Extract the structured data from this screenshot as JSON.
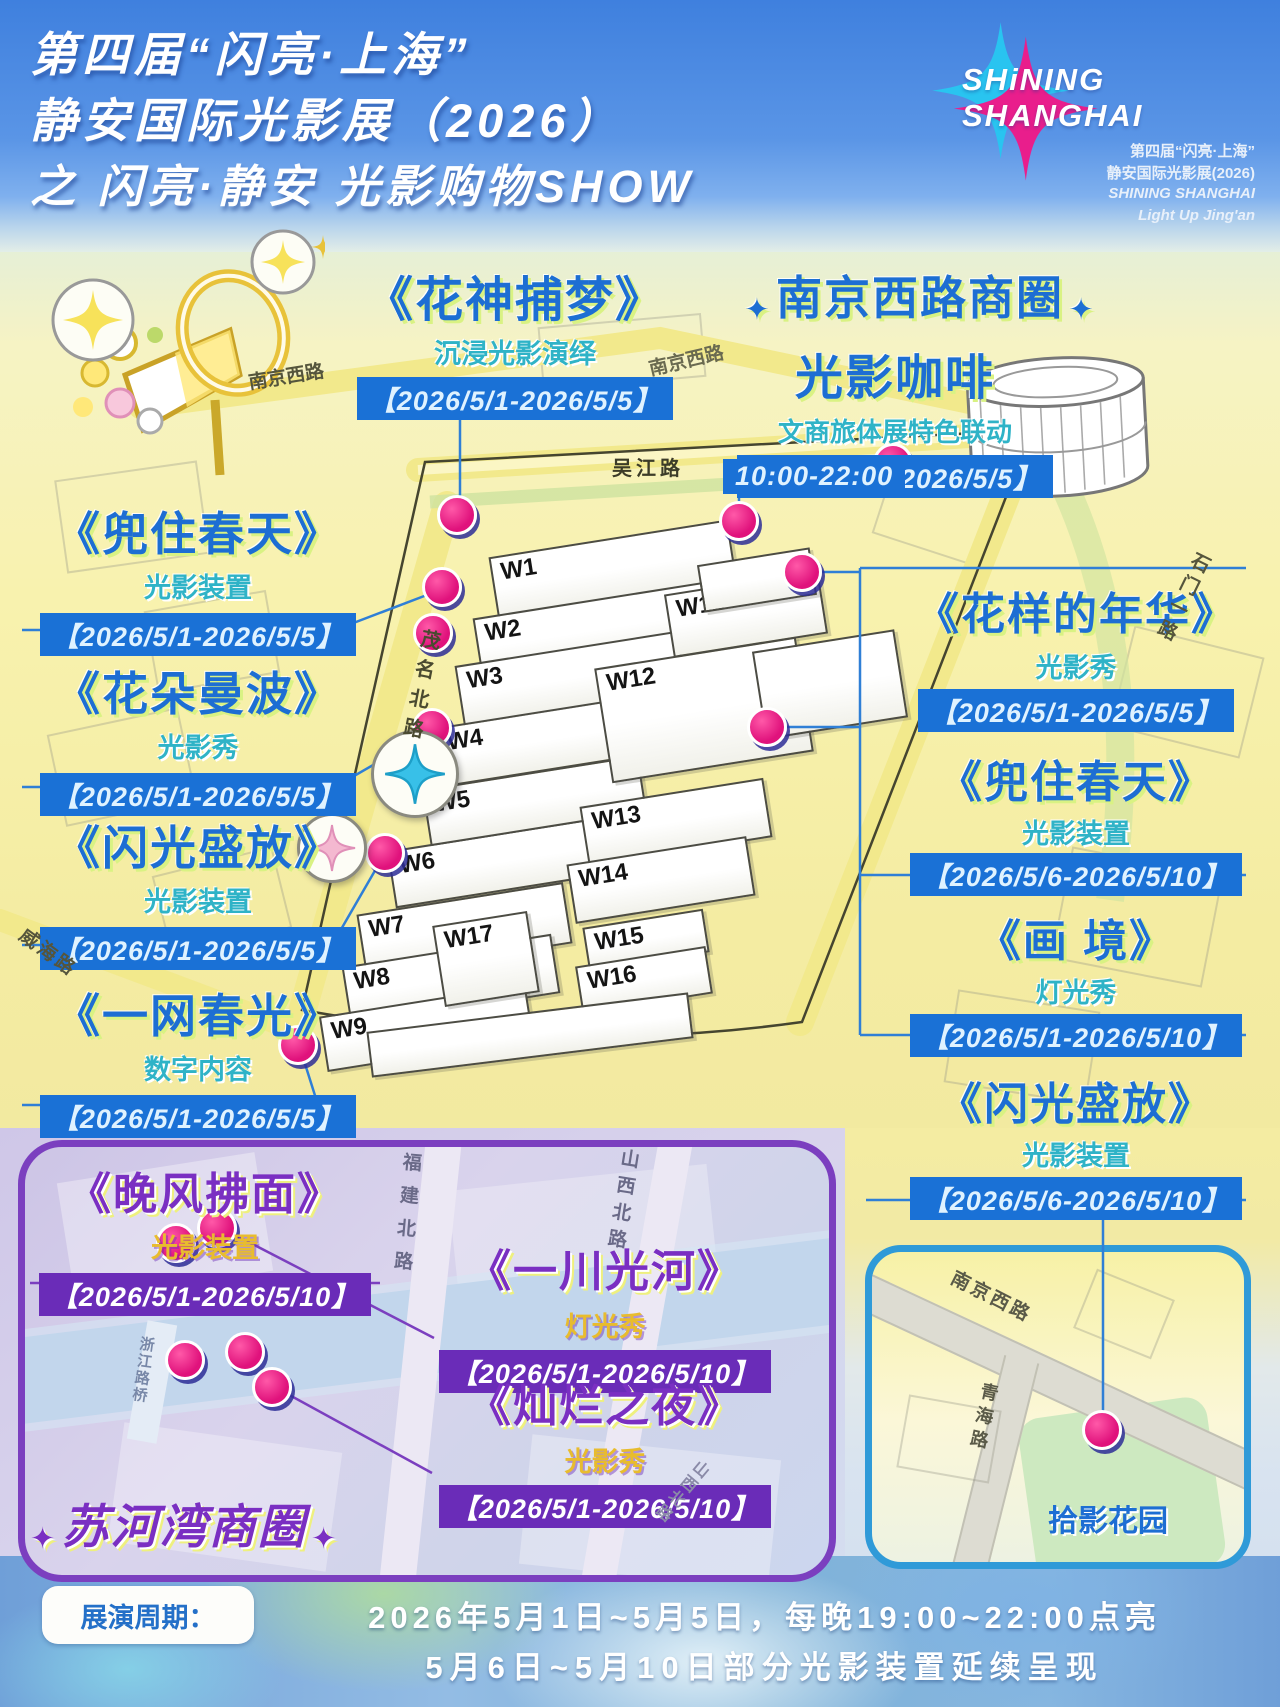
{
  "header": {
    "title_lines": [
      "第四届“闪亮·上海”",
      "静安国际光影展（2026）",
      "之 闪亮·静安 光影购物SHOW"
    ],
    "logo": {
      "name_line1": "SHiNING",
      "name_line2": "SHANGHAI",
      "sub_line1": "第四届“闪亮·上海”",
      "sub_line2": "静安国际光影展(2026)",
      "sub_line3": "SHINING SHANGHAI",
      "sub_line4": "Light Up Jing'an"
    }
  },
  "left_events": [
    {
      "title": "《花神捕梦》",
      "subtitle": "沉浸光影演绎",
      "dates": "【2026/5/1-2026/5/5】"
    },
    {
      "title": "《兜住春天》",
      "subtitle": "光影装置",
      "dates": "【2026/5/1-2026/5/5】"
    },
    {
      "title": "《花朵曼波》",
      "subtitle": "光影秀",
      "dates": "【2026/5/1-2026/5/5】"
    },
    {
      "title": "《闪光盛放》",
      "subtitle": "光影装置",
      "dates": "【2026/5/1-2026/5/5】"
    },
    {
      "title": "《一网春光》",
      "subtitle": "数字内容",
      "dates": "【2026/5/1-2026/5/5】"
    }
  ],
  "nanjing_west": {
    "sparkle": "✦",
    "district_title": "南京西路商圈",
    "coffee": {
      "title": "光影咖啡",
      "subtitle": "文商旅体展特色联动",
      "dates": "【2026/5/1-2026/5/5】",
      "time": "10:00-22:00"
    },
    "events": [
      {
        "title": "《花样的年华》",
        "subtitle": "光影秀",
        "dates": "【2026/5/1-2026/5/5】"
      },
      {
        "title": "《兜住春天》",
        "subtitle": "光影装置",
        "dates": "【2026/5/6-2026/5/10】"
      },
      {
        "title": "《画 境》",
        "subtitle": "灯光秀",
        "dates": "【2026/5/1-2026/5/10】"
      },
      {
        "title": "《闪光盛放》",
        "subtitle": "光影装置",
        "dates": "【2026/5/6-2026/5/10】"
      }
    ]
  },
  "suhewan": {
    "sparkle": "✦",
    "district_title": "苏河湾商圈",
    "events": [
      {
        "title": "《晚风拂面》",
        "subtitle": "光影装置",
        "dates": "【2026/5/1-2026/5/10】"
      },
      {
        "title": "《一川光河》",
        "subtitle": "灯光秀",
        "dates": "【2026/5/1-2026/5/10】"
      },
      {
        "title": "《灿烂之夜》",
        "subtitle": "光影秀",
        "dates": "【2026/5/1-2026/5/10】"
      }
    ],
    "roads": {
      "fujian": "福建北路",
      "shanxi": "山西北路",
      "bridge": "浙江路桥"
    }
  },
  "garden": {
    "label": "拾影花园",
    "roads": {
      "nanjing": "南京西路",
      "qinghai": "青海路"
    }
  },
  "map": {
    "roads": {
      "nanjing_tl": "南京西路",
      "nanjing_mid": "南京西路",
      "wujiang": "吴江路",
      "maoming": "茂名北路",
      "weihai": "威海路",
      "shimen": "石门一路"
    },
    "buildings": [
      "W1",
      "W2",
      "W3",
      "W4",
      "W5",
      "W6",
      "W7",
      "W8",
      "W9",
      "W11",
      "W12",
      "W13",
      "W14",
      "W15",
      "W16",
      "W17"
    ]
  },
  "footer": {
    "label": "展演周期：",
    "line1": "2026年5月1日~5月5日，每晚19:00~22:00点亮",
    "line2": "5月6日~5月10日部分光影装置延续呈现"
  },
  "colors": {
    "accent_blue": "#1d6ed3",
    "teal": "#2fb3c7",
    "badge_blue": "#1a71d6",
    "purple": "#7a2fc2",
    "badge_purple": "#6a2cb8",
    "gold": "#e8bc2e",
    "marker_pink": "#e0127c",
    "logo_pink": "#e91e8c",
    "logo_cyan": "#29c4f0"
  }
}
